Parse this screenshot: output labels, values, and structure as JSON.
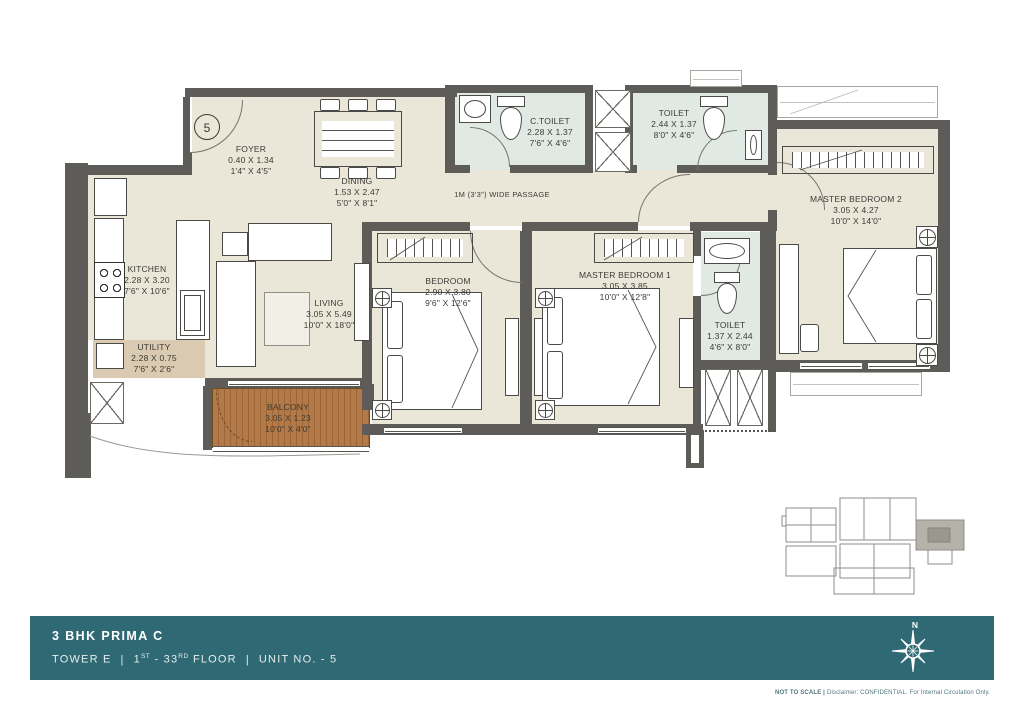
{
  "plan": {
    "unit_circle": "5",
    "passage_label": "1M (3'3\") WIDE PASSAGE",
    "rooms": [
      {
        "name": "FOYER",
        "dim_m": "0.40 X 1.34",
        "dim_ft": "1'4\" X 4'5\""
      },
      {
        "name": "DINING",
        "dim_m": "1.53 X 2.47",
        "dim_ft": "5'0\" X 8'1\""
      },
      {
        "name": "C.TOILET",
        "dim_m": "2.28 X 1.37",
        "dim_ft": "7'6\" X 4'6\""
      },
      {
        "name": "TOILET",
        "dim_m": "2.44 X 1.37",
        "dim_ft": "8'0\" X 4'6\""
      },
      {
        "name": "MASTER BEDROOM 2",
        "dim_m": "3.05 X 4.27",
        "dim_ft": "10'0\" X 14'0\""
      },
      {
        "name": "KITCHEN",
        "dim_m": "2.28 X 3.20",
        "dim_ft": "7'6\" X 10'6\""
      },
      {
        "name": "UTILITY",
        "dim_m": "2.28 X 0.75",
        "dim_ft": "7'6\" X 2'6\""
      },
      {
        "name": "LIVING",
        "dim_m": "3.05 X 5.49",
        "dim_ft": "10'0\" X 18'0\""
      },
      {
        "name": "BEDROOM",
        "dim_m": "2.90 X 3.80",
        "dim_ft": "9'6\" X 12'6\""
      },
      {
        "name": "MASTER BEDROOM 1",
        "dim_m": "3.05 X 3.85",
        "dim_ft": "10'0\" X 12'8\""
      },
      {
        "name": "TOILET",
        "dim_m": "1.37 X 2.44",
        "dim_ft": "4'6\" X 8'0\""
      },
      {
        "name": "BALCONY",
        "dim_m": "3.05 X 1.23",
        "dim_ft": "10'0\" X 4'0\""
      }
    ]
  },
  "footer": {
    "title": "3 BHK PRIMA C",
    "tower": "TOWER E",
    "sep": "|",
    "floor_a": "1",
    "floor_a_sup": "ST",
    "floor_b": "- 33",
    "floor_b_sup": "RD",
    "floor_c": "FLOOR",
    "unit": "UNIT NO. - 5",
    "compass_n": "N"
  },
  "disclaimer": {
    "bold": "NOT TO SCALE |",
    "rest": "Disclaimer: CONFIDENTIAL. For Internal Circulation Only."
  },
  "colors": {
    "banner_teal": "#2e6974",
    "wall_gray": "#5d5c58",
    "floor_beige": "#eae6d8",
    "toilet_tile": "#e0e9e4",
    "balcony_wood": "#b27a48",
    "utility_tan": "#d9cab1"
  }
}
